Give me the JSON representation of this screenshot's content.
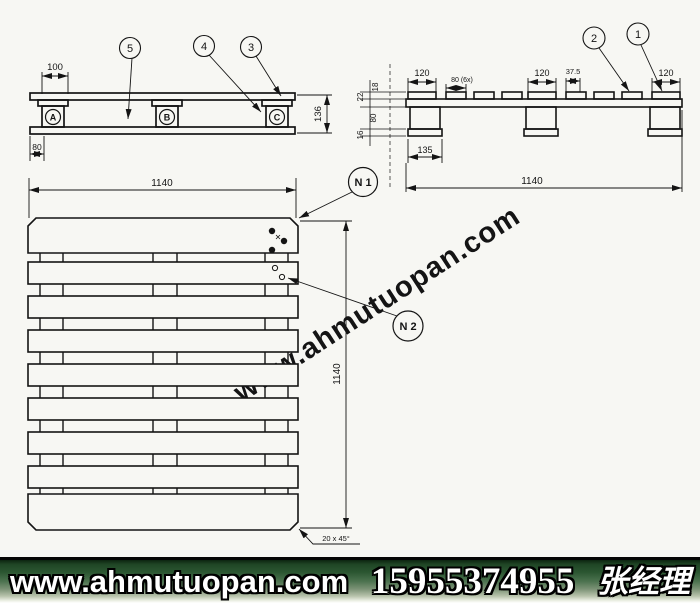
{
  "left_view": {
    "dims": {
      "top": "100",
      "height": "136",
      "bottom_left": "80",
      "width": "1140"
    },
    "callouts": [
      "5",
      "4",
      "3"
    ],
    "blocks": [
      "A",
      "B",
      "C"
    ]
  },
  "right_view": {
    "dims": {
      "deck_left": "120",
      "deck_mid": "120",
      "deck_right": "120",
      "spacing": "80 (6x)",
      "gap": "37.5",
      "side_top": "18",
      "side_board": "22",
      "side_block": "80",
      "side_plate": "16",
      "plate_width": "135",
      "width": "1140"
    },
    "callouts": [
      "2",
      "1"
    ]
  },
  "plan_view": {
    "dims": {
      "height": "1140"
    },
    "callouts": {
      "n1": "N 1",
      "n2": "N 2"
    },
    "chamfer_note": "20 x 45°"
  },
  "watermark": "www.ahmutuopan.com",
  "banner": {
    "website": "www.ahmutuopan.com",
    "phone": "15955374955",
    "contact": "张经理"
  },
  "colors": {
    "line": "#141414",
    "banner_green": "#1f4525"
  }
}
